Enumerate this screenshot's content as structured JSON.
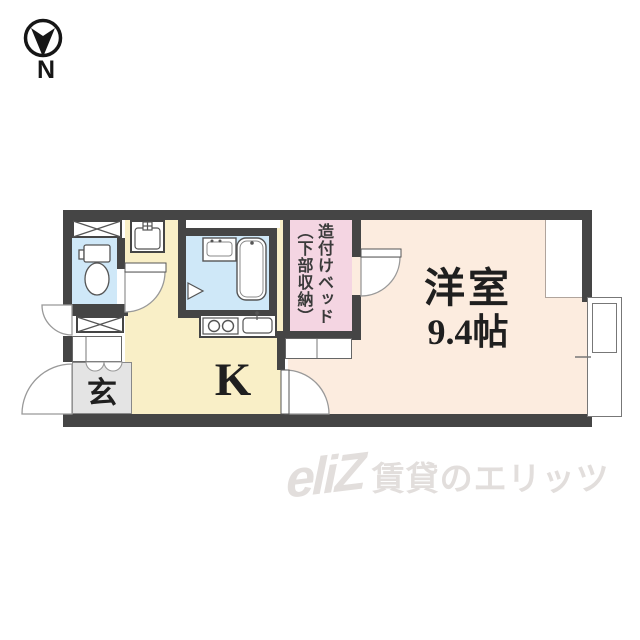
{
  "compass": {
    "label": "N"
  },
  "floor_plan": {
    "rooms": {
      "western": {
        "name": "洋室",
        "area": "9.4帖"
      },
      "kitchen": {
        "label": "K"
      },
      "entrance": {
        "label": "玄"
      },
      "bed_closet": {
        "line1": "造付けベッド",
        "line2": "（下部収納）"
      }
    },
    "fixtures": [
      "toilet",
      "bathtub",
      "bath-sink",
      "washer-pan",
      "stove-2-burner",
      "kitchen-sink",
      "shoe-cabinet",
      "storage-x-box",
      "built-in-bed",
      "shelf",
      "sliding-window",
      "pipe-space"
    ],
    "doors": [
      "entrance-door",
      "utility-door",
      "toilet-door",
      "bath-folding-door",
      "bed-closet-door",
      "room-door"
    ]
  },
  "watermark": {
    "logo": "eliZ",
    "text": "賃貸のエリッツ"
  },
  "colors": {
    "wall": "#454545",
    "western_room": "#fcecdf",
    "bed_closet": "#f4d5e2",
    "kitchen": "#f9efc7",
    "water_blue": "#cfe8f8",
    "entrance_gray": "#e4e4e4",
    "watermark": "#e2dedc"
  }
}
